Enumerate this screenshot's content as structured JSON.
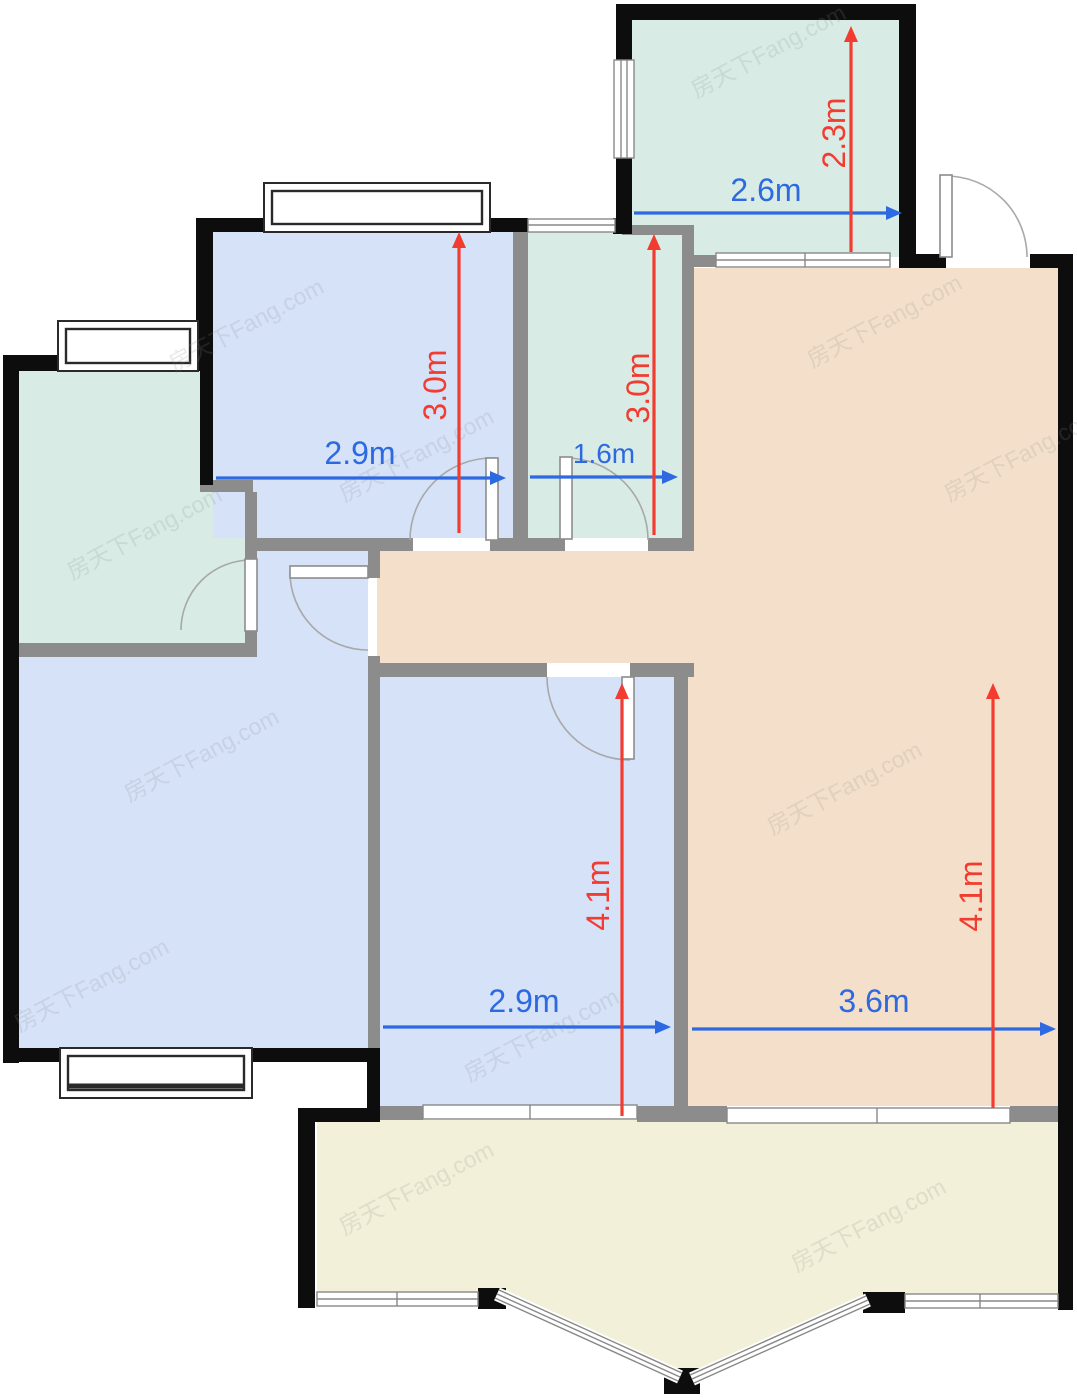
{
  "dimensions": {
    "kitchen_width": "2.6m",
    "kitchen_depth": "2.3m",
    "bedroom1_width": "2.9m",
    "bedroom1_depth": "3.0m",
    "bathroom_width": "1.6m",
    "bathroom_depth": "3.0m",
    "bedroom2_width": "2.9m",
    "bedroom2_depth": "4.1m",
    "living_width": "3.6m",
    "living_depth": "4.1m"
  },
  "watermark": {
    "text": "房天下Fang.com"
  },
  "colors": {
    "white": "#ffffff",
    "room_blue": "#d5e2f8",
    "room_teal": "#d8ece5",
    "room_tan": "#f4e0ca",
    "balcony_cream": "#f2f0d8",
    "wall_black": "#0d0d0d",
    "wall_gray": "#8c8c8c",
    "window_frame": "#2a2a2a",
    "window_line": "#888888",
    "door_line": "#a8a8a8",
    "dim_blue": "#2d69e1",
    "dim_red": "#f33c30",
    "watermark_gray": "#8c8c8c"
  }
}
